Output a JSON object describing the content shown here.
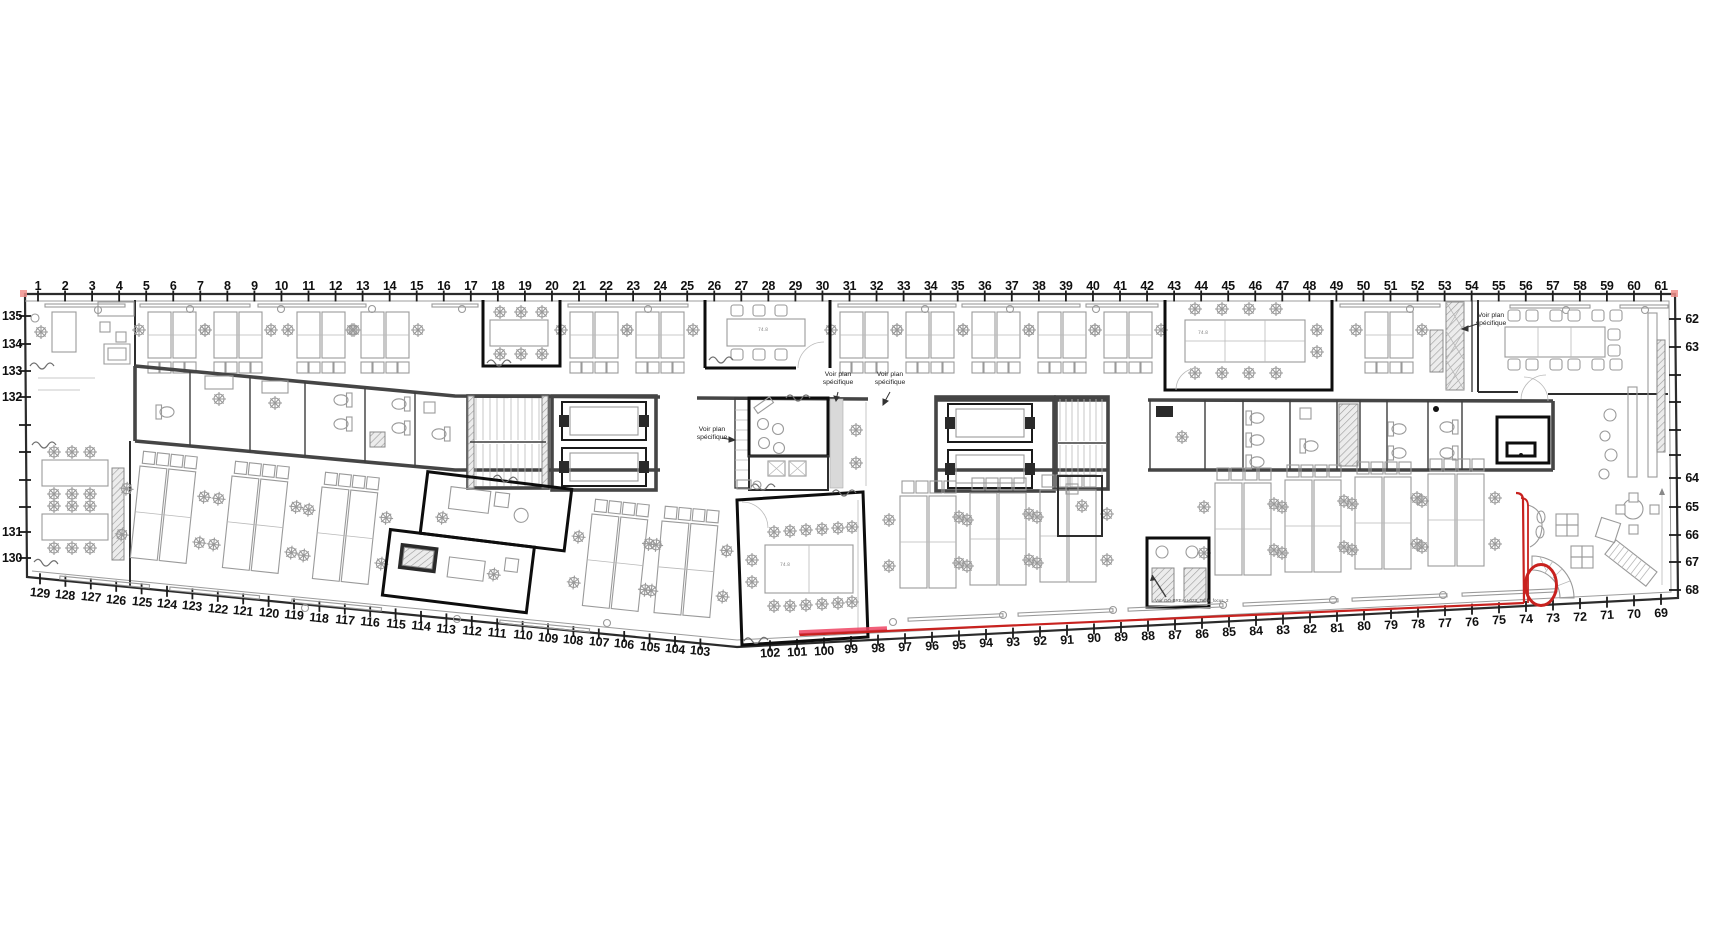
{
  "drawing": {
    "type": "architectural floor plan",
    "colors": {
      "route_red": "#c8221f",
      "route_highlight": "#ee4463",
      "wall_dark": "#0d0d0d",
      "line_gray": "#9a9a9a",
      "corner_mark": "#f0908c"
    }
  },
  "grid": {
    "top": [
      "1",
      "2",
      "3",
      "4",
      "5",
      "6",
      "7",
      "8",
      "9",
      "10",
      "11",
      "12",
      "13",
      "14",
      "15",
      "16",
      "17",
      "18",
      "19",
      "20",
      "21",
      "22",
      "23",
      "24",
      "25",
      "26",
      "27",
      "28",
      "29",
      "30",
      "31",
      "32",
      "33",
      "34",
      "35",
      "36",
      "37",
      "38",
      "39",
      "40",
      "41",
      "42",
      "43",
      "44",
      "45",
      "46",
      "47",
      "48",
      "49",
      "50",
      "51",
      "52",
      "53",
      "54",
      "55",
      "56",
      "57",
      "58",
      "59",
      "60",
      "61"
    ],
    "left": [
      "135",
      "134",
      "133",
      "132",
      "131",
      "130"
    ],
    "right": [
      "62",
      "63",
      "64",
      "65",
      "66",
      "67",
      "68"
    ],
    "bottom_left": [
      "129",
      "128",
      "127",
      "126",
      "125",
      "124",
      "123",
      "122",
      "121",
      "120",
      "119",
      "118",
      "117",
      "116",
      "115",
      "114",
      "113",
      "112",
      "111",
      "110",
      "109",
      "108",
      "107",
      "106",
      "105",
      "104",
      "103"
    ],
    "bottom_right": [
      "102",
      "101",
      "100",
      "99",
      "98",
      "97",
      "96",
      "95",
      "94",
      "93",
      "92",
      "91",
      "90",
      "89",
      "88",
      "87",
      "86",
      "85",
      "84",
      "83",
      "82",
      "81",
      "80",
      "79",
      "78",
      "77",
      "76",
      "75",
      "74",
      "73",
      "72",
      "71",
      "70",
      "69"
    ]
  },
  "annotations": [
    {
      "id": "a1",
      "text": "Voir plan spécifique"
    },
    {
      "id": "a2",
      "text": "Voir plan spécifique"
    },
    {
      "id": "a3",
      "text": "Voir plan spécifique"
    },
    {
      "id": "a4",
      "text": "Voir plan spécifique"
    },
    {
      "id": "a5",
      "text": "Voir GO-BREAU-023_Table_focus_2"
    }
  ],
  "misc": {
    "table_dim": "74.8"
  }
}
